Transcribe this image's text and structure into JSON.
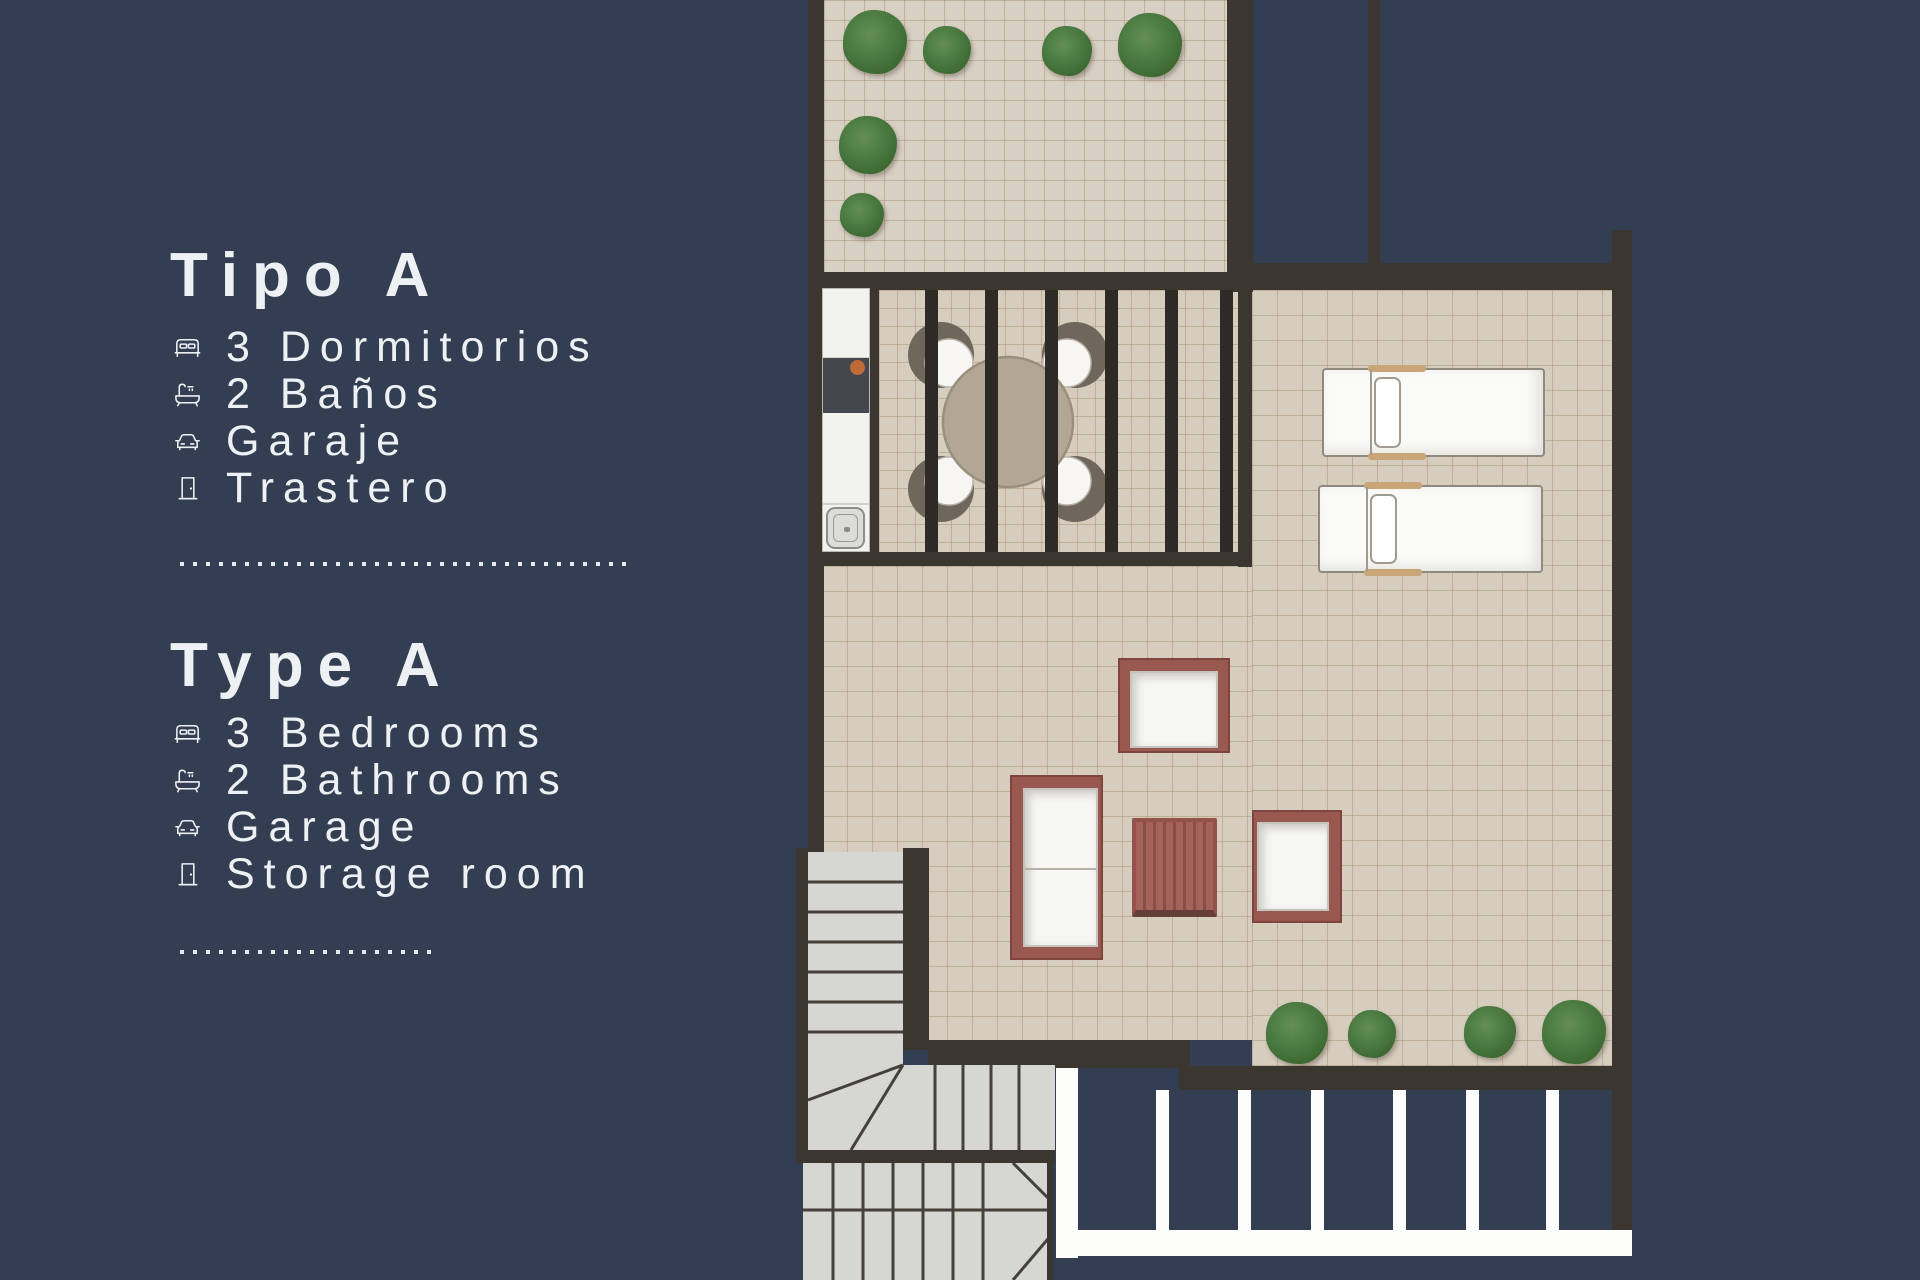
{
  "panel": {
    "title_es": "Tipo A",
    "features_es": [
      {
        "icon": "bed-icon",
        "label": "3 Dormitorios"
      },
      {
        "icon": "bathtub-icon",
        "label": "2 Baños"
      },
      {
        "icon": "car-icon",
        "label": "Garaje"
      },
      {
        "icon": "door-icon",
        "label": "Trastero"
      }
    ],
    "title_en": "Type A",
    "features_en": [
      {
        "icon": "bed-icon",
        "label": "3 Bedrooms"
      },
      {
        "icon": "bathtub-icon",
        "label": "2 Bathrooms"
      },
      {
        "icon": "car-icon",
        "label": "Garage"
      },
      {
        "icon": "door-icon",
        "label": "Storage room"
      }
    ]
  },
  "floorplan": {
    "type": "roof-terrace plan, unit Type A",
    "areas": [
      "roof-terrace-garden",
      "pergola-dining-area",
      "kitchenette-counter",
      "sun-lounger-deck",
      "lounge-terrace",
      "staircase",
      "parking-bays"
    ],
    "furniture": [
      "round-dining-table-with-4-chairs",
      "sun-lounger",
      "sun-lounger",
      "armchair",
      "two-seat-sofa",
      "slatted-coffee-table",
      "armchair"
    ],
    "plants_top_terrace": 6,
    "plants_lower_terrace": 4,
    "pergola_slats": 6,
    "parking_divider_stripes": 6
  },
  "colors": {
    "navy": "#333e52",
    "wall": "#3b362f",
    "floor": "#d7cdbf",
    "text": "#eef1f4",
    "maroon": "#9a5950",
    "stair": "#d6d6d3"
  }
}
